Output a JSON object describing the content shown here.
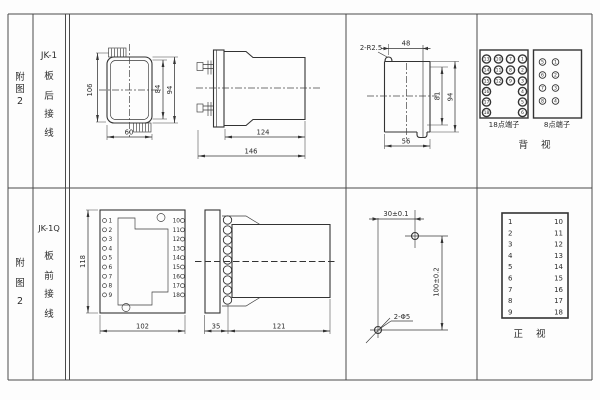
{
  "sheet_title": "relay-installation-drawing",
  "rows": {
    "top": {
      "figure_label": [
        "附",
        "图",
        "2"
      ],
      "model": "JK-1",
      "wiring_label": [
        "板",
        "后",
        "接",
        "线"
      ],
      "case_view": {
        "dim_height": "106",
        "dim_inner_height": "84",
        "dim_outer_height": "94",
        "dim_width": "60"
      },
      "side_view": {
        "dim_body": "124",
        "dim_total": "146"
      },
      "cutout_view": {
        "radius_note": "2-R2.5",
        "dim_top": "48",
        "dim_inner": "81",
        "dim_outer": "94",
        "dim_bottom": "56"
      },
      "terminal18": {
        "label": "18点端子",
        "col1": [
          "13",
          "14",
          "15",
          "16",
          "17",
          "18"
        ],
        "col2": [
          "10",
          "11",
          "12"
        ],
        "col3": [
          "7",
          "8",
          "9"
        ],
        "col4": [
          "1",
          "2",
          "3",
          "4",
          "5",
          "6"
        ]
      },
      "terminal8": {
        "label": "8点端子",
        "left": [
          "5",
          "6",
          "7",
          "8"
        ],
        "right": [
          "1",
          "2",
          "3",
          "4"
        ]
      },
      "view_label": "背 视"
    },
    "bottom": {
      "figure_label": [
        "附",
        "图",
        "2"
      ],
      "model": "JK-1Q",
      "wiring_label": [
        "板",
        "前",
        "接",
        "线"
      ],
      "base_view": {
        "dim_height": "118",
        "dim_width": "102",
        "left_terminals": [
          "1",
          "2",
          "3",
          "4",
          "5",
          "6",
          "7",
          "8",
          "9"
        ],
        "right_terminals": [
          "10",
          "11",
          "12",
          "13",
          "14",
          "15",
          "16",
          "17",
          "18"
        ]
      },
      "side_view": {
        "dim_flange": "35",
        "dim_body": "121"
      },
      "drill_view": {
        "dim_horizontal": "30±0.1",
        "dim_vertical": "100±0.2",
        "hole_note": "2-Φ5"
      },
      "front_table": {
        "left": [
          "1",
          "2",
          "3",
          "4",
          "5",
          "6",
          "7",
          "8",
          "9"
        ],
        "right": [
          "10",
          "11",
          "12",
          "13",
          "14",
          "15",
          "16",
          "17",
          "18"
        ]
      },
      "view_label": "正 视"
    }
  }
}
